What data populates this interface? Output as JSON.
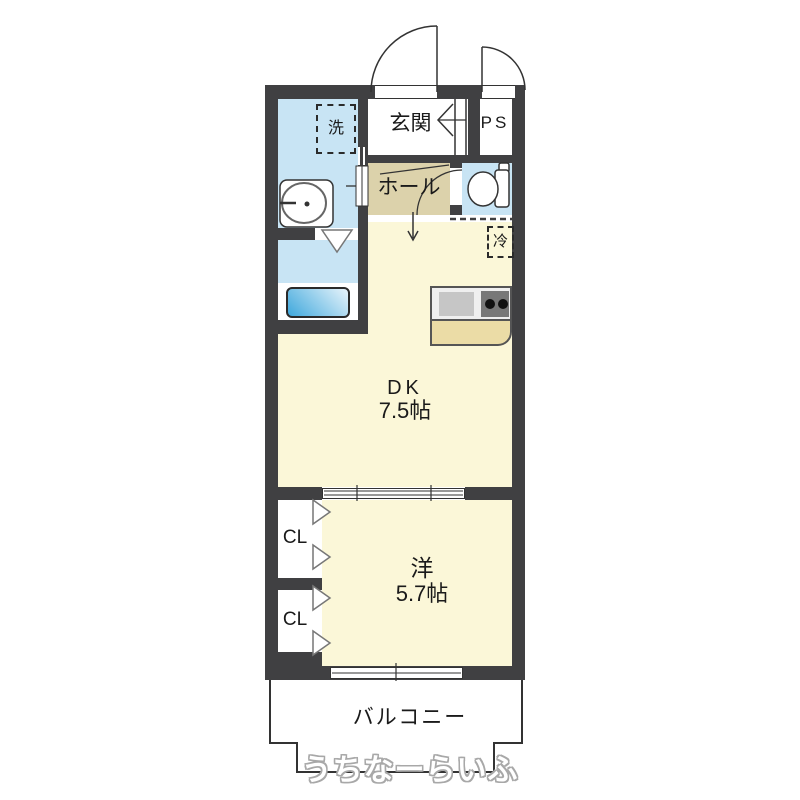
{
  "colors": {
    "wall": "#404042",
    "water_room": "#C8E4F4",
    "room_yellow": "#FBF7D8",
    "hall_tan": "#DCD2AB",
    "counter_front": "#EBDCA6",
    "counter_top": "#EFEFEF",
    "sink_gray": "#C6C6C6",
    "stove_gray": "#787878",
    "tub_blue": "#3FA8DC",
    "line": "#333333"
  },
  "labels": {
    "entrance": "玄関",
    "ps": "PS",
    "hall": "ホール",
    "washer": "洗",
    "fridge": "冷",
    "dk_name": "DK",
    "dk_size": "7.5帖",
    "western_name": "洋",
    "western_size": "5.7帖",
    "closet_upper": "CL",
    "closet_lower": "CL",
    "balcony": "バルコニー",
    "watermark": "うちなーらいふ"
  }
}
